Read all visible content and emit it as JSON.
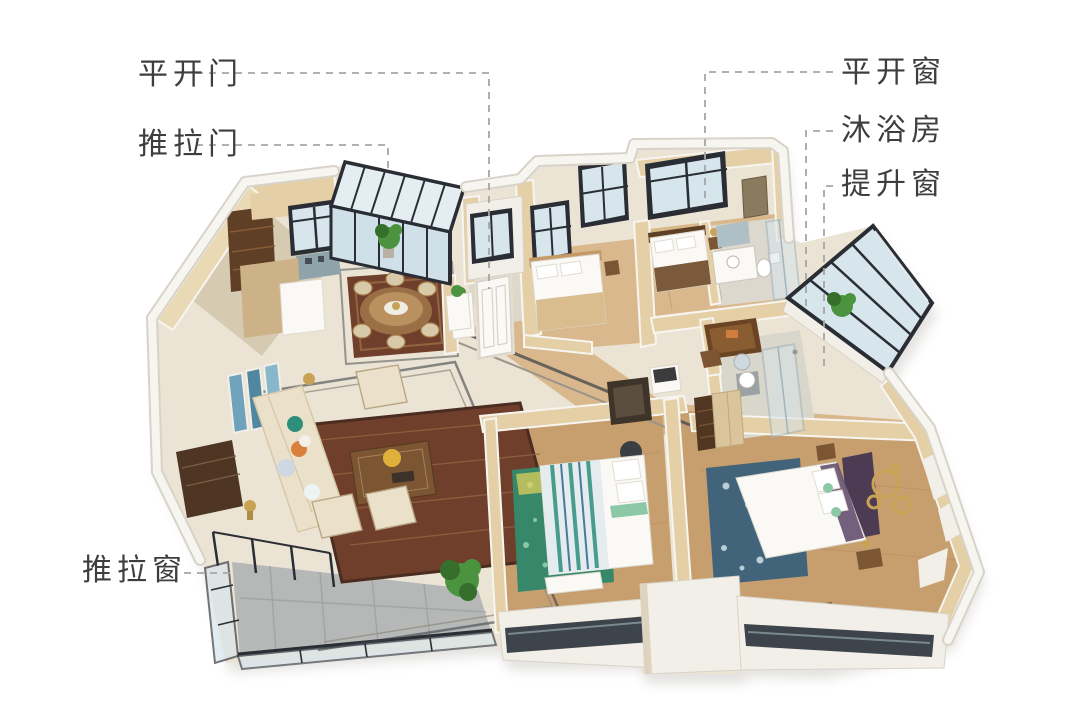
{
  "page": {
    "kind": "3d-floorplan-annotated",
    "background": "#ffffff"
  },
  "palette": {
    "bg": "#ffffff",
    "label": "#3e3e3e",
    "leader": "#a6a6a6",
    "wall_top": "#f7f5f0",
    "wall_edge": "#d8d3c9",
    "wall_face": "#e5cfa6",
    "wall_face_light": "#ead9b5",
    "wall_white": "#f2efe8",
    "marble": "#ebe4d4",
    "marble_dark": "#ddd3bf",
    "wood": "#c79f6f",
    "wood_light": "#d8b88c",
    "wood_dark": "#a87e50",
    "gray_floor": "#b5b8b7",
    "gray_floor_dark": "#9da1a0",
    "rug_red": "#6f3f2c",
    "rug_red_light": "#94643f",
    "rug_teal": "#37886a",
    "rug_teal_light": "#8cc7a6",
    "rug_blue": "#41647b",
    "rug_blue_light": "#b8cdd6",
    "frame": "#2a2e34",
    "glass": "#d7e5ec",
    "glass_dark": "#c2d6e0",
    "glaze": "#3d444b",
    "sofa": "#ebe1ca",
    "brown": "#7c5533",
    "dark_brown": "#54391f",
    "white_f": "#faf9f6",
    "gold": "#c9a355",
    "orange": "#d8813c",
    "teal": "#2e8f7d",
    "purple": "#5a4566",
    "plant": "#4c9340",
    "plant_dark": "#356f2b",
    "charcoal": "#3b3e42"
  },
  "annotations": {
    "labels": [
      {
        "id": "swing-door",
        "text": "平开门",
        "leader": "M196,73 H489 V289"
      },
      {
        "id": "sliding-door",
        "text": "推拉门",
        "leader": "M196,145 H388 V169"
      },
      {
        "id": "casement-window",
        "text": "平开窗",
        "leader": "M833,72 H705 V199"
      },
      {
        "id": "shower-room",
        "text": "沐浴房",
        "leader": "M833,131 H806 V306"
      },
      {
        "id": "lift-window",
        "text": "提升窗",
        "leader": "M833,186 H824 V369"
      },
      {
        "id": "sliding-window",
        "text": "推拉窗",
        "leader": "M184,573 H233"
      }
    ]
  }
}
